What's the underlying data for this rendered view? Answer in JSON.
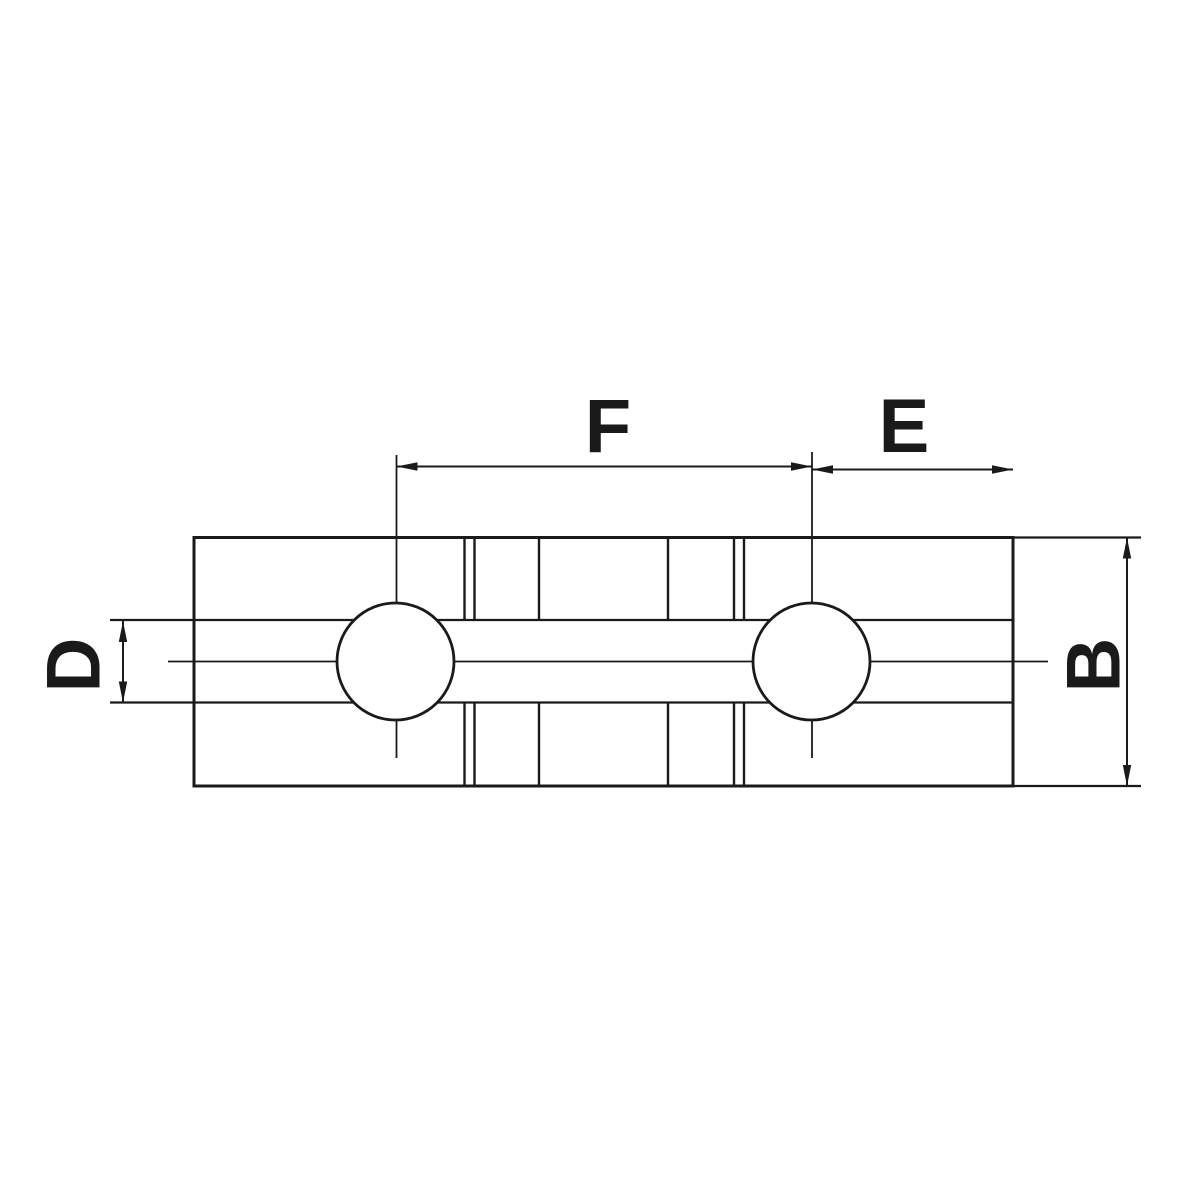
{
  "drawing": {
    "type": "technical-dimension-drawing",
    "labels": {
      "f": "F",
      "e": "E",
      "d": "D",
      "b": "B"
    },
    "colors": {
      "line": "#1a1a1a",
      "background": "#ffffff"
    }
  }
}
